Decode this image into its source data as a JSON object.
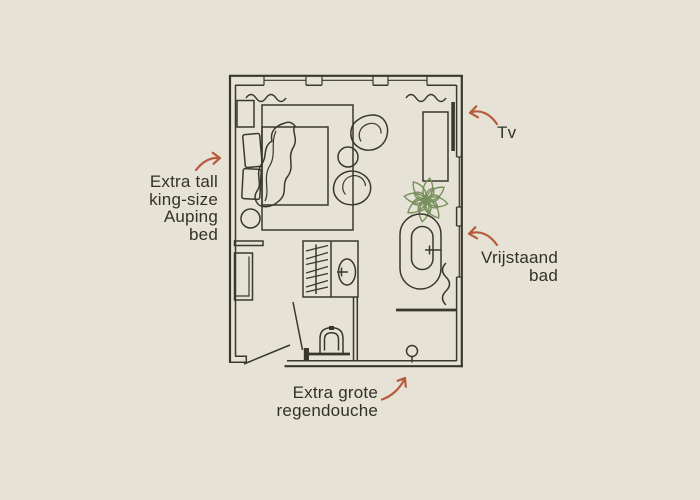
{
  "page": {
    "background": "#e6e2d5"
  },
  "palette": {
    "bg": "#e6e2d5",
    "line": "#3a382e",
    "text": "#333127",
    "arrow": "#b75b3e",
    "plant": "#78905e"
  },
  "labels": {
    "bed": {
      "lines": [
        "Extra tall",
        "king-size",
        "Auping",
        "bed"
      ]
    },
    "tv": {
      "text": "Tv"
    },
    "bath": {
      "lines": [
        "Vrijstaand",
        "bad"
      ]
    },
    "shower": {
      "lines": [
        "Extra grote",
        "regendouche"
      ]
    }
  },
  "floorplan": {
    "features": [
      "king-size-bed",
      "pillows",
      "duvet",
      "nightstand",
      "rug",
      "stool",
      "armchair",
      "armchair",
      "side-table",
      "tv",
      "tv-cabinet",
      "plant",
      "freestanding-bathtub",
      "towel-radiator",
      "washbasin",
      "toilet",
      "walk-in-shower-drain",
      "wardrobe",
      "curtains",
      "doors",
      "windows"
    ]
  }
}
